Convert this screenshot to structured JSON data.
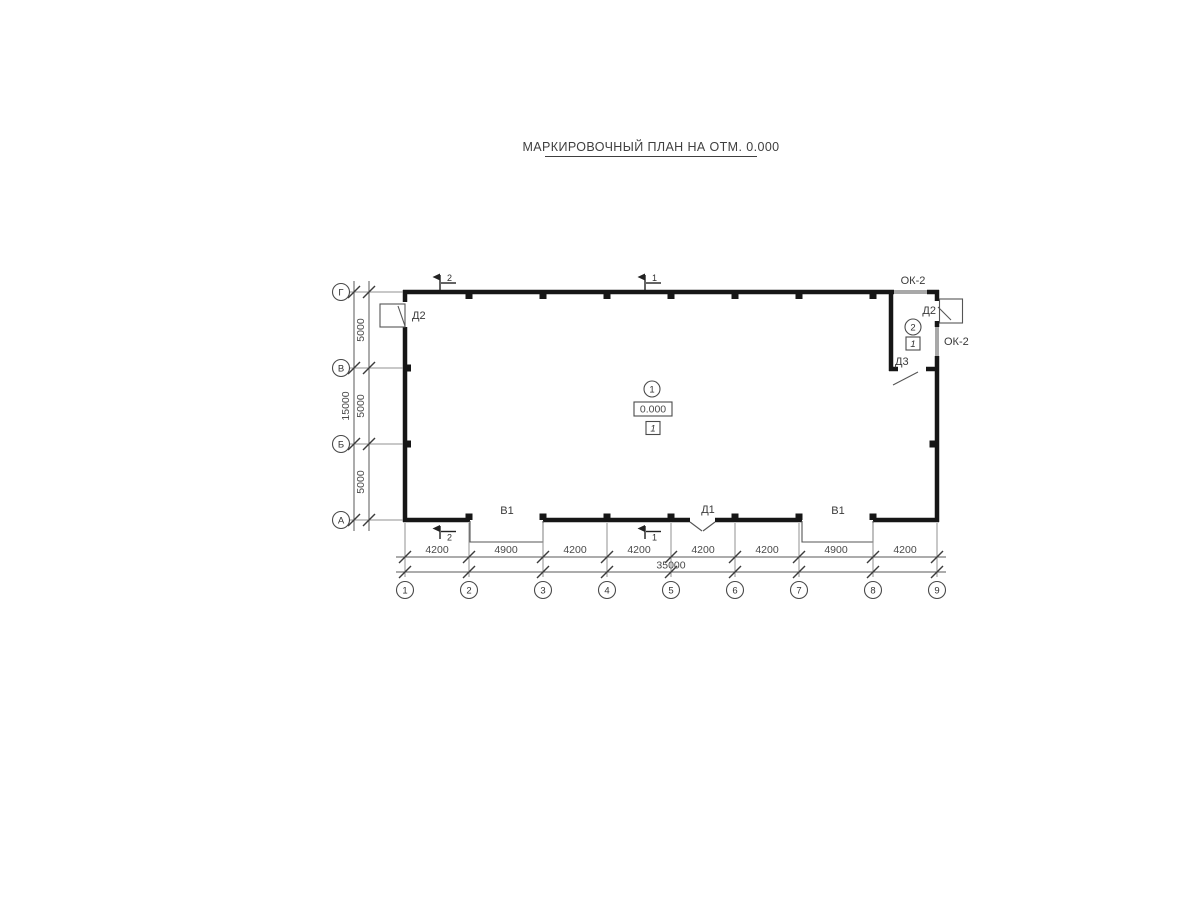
{
  "title": {
    "text": "МАРКИРОВОЧНЫЙ ПЛАН НА ОТМ. 0.000"
  },
  "axes": {
    "columns": [
      "1",
      "2",
      "3",
      "4",
      "5",
      "6",
      "7",
      "8",
      "9"
    ],
    "rows": [
      "Г",
      "В",
      "Б",
      "А"
    ]
  },
  "dims": {
    "bottom": [
      "4200",
      "4900",
      "4200",
      "4200",
      "4200",
      "4200",
      "4900",
      "4200"
    ],
    "bottom_total": "35000",
    "left": [
      "5000",
      "5000",
      "5000"
    ],
    "left_total": "15000"
  },
  "marks": {
    "doors": {
      "d2_left": "Д2",
      "d2_right": "Д2",
      "d3": "Д3",
      "d1": "Д1"
    },
    "gates": {
      "b1_left": "В1",
      "b1_right": "В1"
    },
    "windows": {
      "ok2_top": "ОК-2",
      "ok2_right": "ОК-2"
    },
    "sections": {
      "s1": "1",
      "s2": "2"
    }
  },
  "rooms": {
    "room1": {
      "number": "1",
      "elevation": "0.000",
      "floor_type": "1"
    },
    "room2": {
      "number": "2",
      "floor_type": "1"
    }
  },
  "colors": {
    "wall": "#161616",
    "window": "#a8a8a8",
    "line": "#555555",
    "text": "#3a3a3a",
    "background": "#ffffff"
  }
}
